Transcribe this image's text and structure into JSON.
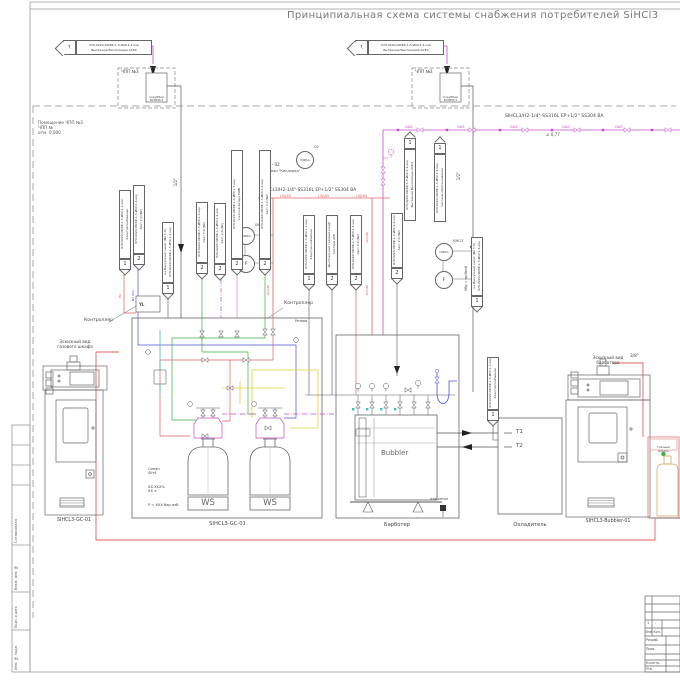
{
  "title": "Принципиальная схема системы снабжения потребителей SiHCl3",
  "frame": {
    "stamps": [
      "Согласовано",
      "Взам. инв. №",
      "Подп. и дата",
      "Инв. № подл."
    ]
  },
  "rooms": {
    "chpp": "ЧПП №3",
    "note1": "Помещение ЧПП №3",
    "note2": "ЧПП №",
    "note3": "отм. 0,000"
  },
  "scrubber": {
    "name1": "Скруббер",
    "name2": "БСКРЛ/1"
  },
  "vent_flag": {
    "n": "1",
    "l1": "070-0220-ОКЭФ-1-5-ИОС1.2-кор",
    "l2": "Вытяжная Вентиляция АСЕХ"
  },
  "lines": {
    "gas_spec": "SIHCL3/H2-1/4\"-SS316L EP+1/2\" SS304 BA",
    "liquid_spec": "SIHCL3/H2-1/4\"-SS316L EP+1/2\" SS304 BA",
    "slope": "∠ 0,77",
    "gas_tag": "GAS",
    "liquid_tag": "LIQUID",
    "pg_tag": "PG",
    "n2_tag": "N2 (PA)",
    "half_inch": "1/2\"",
    "three_eighth": "3/8\"",
    "sample": "Обр. с трубкой"
  },
  "oxygen": {
    "code": "L - 02",
    "label": "Сигнал \"Кислород\"",
    "inst": "QIRSA",
    "sup": "O2"
  },
  "inst": {
    "qirsa": "QIRSA",
    "flow": "F",
    "medium": "SiHCl3"
  },
  "controller": "Контроллер",
  "yl": "YL",
  "reserve": "Резерв",
  "left_cabinet": {
    "cap1": "Эскизный вид",
    "cap2": "газового шкафа",
    "label": "SIHCL3-GC-01"
  },
  "center_unit": {
    "label": "SIHCL3-GC-01",
    "ws": "WS",
    "note": [
      "Силан",
      "SiH4",
      "XX.XXX%",
      "ХХ л",
      "P = XXX бар изб"
    ]
  },
  "bubbler": {
    "name": "Bubbler",
    "label": "Барботер",
    "leak": "leak sensor"
  },
  "cooler": {
    "label": "Охладитель",
    "t1": "T1",
    "t2": "T2"
  },
  "right_cabinet": {
    "cap1": "Эскизный вид",
    "cap2": "барботера",
    "label": "SIHCL3-Bubbler-01"
  },
  "cylinder": {
    "cap1": "Газовый",
    "cap2": "баллон"
  },
  "flags": [
    {
      "n": "1",
      "l1": "070-0220-ОКЭФ-1-5-ИОС1.1-кор",
      "l2": "Электроснабжение"
    },
    {
      "n": "2",
      "l1": "070-0220-ОКЭФ-1-5-ИОС1.4-кор",
      "l2": "Азот 2.0 (N2)"
    },
    {
      "n": "1",
      "l1": "на Вакуумный насос (N2 5.0)",
      "l2": "070-0220-ОКЭФ-1-5-ИОС1.4-кор"
    },
    {
      "n": "2",
      "l1": "070-0220-ОКЭФ-1-5-ИОС1.3-кор",
      "l2": "Азот 3.0 (N2)"
    },
    {
      "n": "2",
      "l1": "070-0220-ОКЭФ-1-5-ИОС1.4-кор",
      "l2": "Азот 2.0 (N2)"
    },
    {
      "n": "2",
      "l1": "070-0220-ОКЭФ-1-5-ИОС1.5-кор",
      "l2": "Сжатый воздух КИП"
    },
    {
      "n": "2",
      "l1": "070-0220-ОКЭФ-1-5-ИОС1.4-кор",
      "l2": "Азот 3.0 (N2)"
    },
    {
      "n": "1",
      "l1": "070-0220-ОКЭФ-1-5-ИОС1.1-кор",
      "l2": "Электроснабжение"
    },
    {
      "n": "2",
      "l1": "Центральный газовый шкаф",
      "l2": "Система АГЕ"
    },
    {
      "n": "2",
      "l1": "070-0220-ОКЭФ-1-5-ИОС1.5-кор",
      "l2": "Азот 2.0 (N2)"
    },
    {
      "n": "2",
      "l1": "070-0220-ОКЭФ-1-5-ИОС1.4-кор",
      "l2": "Азот 2.0 (N2)"
    },
    {
      "n": "1",
      "l1": "на Вакуумный насос (N2 5.0)",
      "l2": "070-0220-ОКЭФ-1-5-ИОС1.4-кор"
    },
    {
      "n": "1",
      "l1": "070-0220-ОКЭФ-1-5-ИОС1.1-кор",
      "l2": "Электроснабжение"
    },
    {
      "n": "1",
      "l1": "070-0220-ОКЭФ-1-5-ИОС1.2-кор",
      "l2": "Вытяжная Вентиляция АСЕХ"
    },
    {
      "n": "1",
      "l1": "070-0220-ОКЭФ-1-5-ИОС1.6-кор",
      "l2": "Система обеспыливания"
    }
  ],
  "title_block": {
    "r1": "1",
    "r2": "-",
    "izm": "Изм.",
    "kol": "Кол.",
    "rows": [
      "Разраб.",
      "Пров.",
      "Н.контр.",
      "Утв."
    ]
  },
  "colors": {
    "gas": "#c44fc4",
    "liquid": "#e06060",
    "green": "#3cb043",
    "blue": "#4953d8",
    "yellow": "#ddd13a",
    "cyan": "#3fbfbf",
    "line": "#555555"
  }
}
